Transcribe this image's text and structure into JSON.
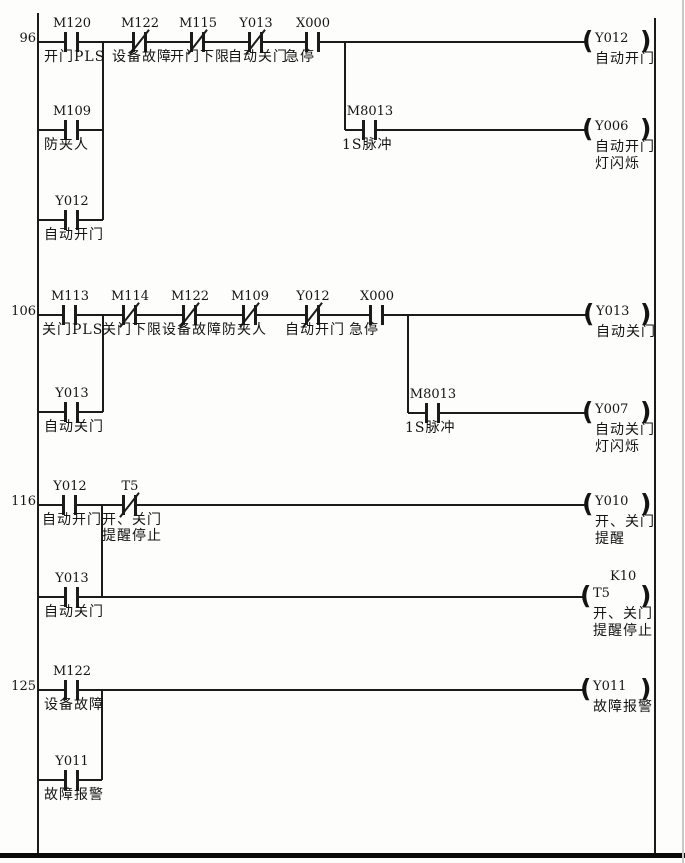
{
  "diagram": {
    "type": "plc-ladder",
    "bg_color": "#fdfdfc",
    "line_color": "#1b1b1b",
    "rails": {
      "left_x": 38,
      "right_x": 655,
      "top_y": 13,
      "right_top_y": 18,
      "bottom_y": 855
    },
    "frame": {
      "bottom_bar_y": 853,
      "bottom_bar_h": 5,
      "right_edge_x": 682
    },
    "rungs": [
      {
        "number": "96",
        "y": 42,
        "wires": [
          {
            "t": "h",
            "x1": 38,
            "x2": 585,
            "y": 42
          },
          {
            "t": "v",
            "x": 103,
            "y1": 42,
            "y2": 220
          },
          {
            "t": "h",
            "x1": 38,
            "x2": 103,
            "y": 130
          },
          {
            "t": "v",
            "x": 345,
            "y1": 42,
            "y2": 130
          },
          {
            "t": "h",
            "x1": 345,
            "x2": 585,
            "y": 130
          },
          {
            "t": "h",
            "x1": 38,
            "x2": 103,
            "y": 220
          }
        ],
        "contacts": [
          {
            "x": 72,
            "y": 42,
            "name": "M120",
            "label": [
              "开门PLS"
            ],
            "nc": false
          },
          {
            "x": 140,
            "y": 42,
            "name": "M122",
            "label": [
              "设备故障"
            ],
            "nc": true
          },
          {
            "x": 198,
            "y": 42,
            "name": "M115",
            "label": [
              "开门下限"
            ],
            "nc": true
          },
          {
            "x": 256,
            "y": 42,
            "name": "Y013",
            "label": [
              "自动关门"
            ],
            "nc": true
          },
          {
            "x": 313,
            "y": 42,
            "name": "X000",
            "label": [
              "急停"
            ],
            "nc": false
          },
          {
            "x": 72,
            "y": 130,
            "name": "M109",
            "label": [
              "防夹人"
            ],
            "nc": false
          },
          {
            "x": 370,
            "y": 130,
            "name": "M8013",
            "label": [
              "1S脉冲"
            ],
            "nc": false
          },
          {
            "x": 72,
            "y": 220,
            "name": "Y012",
            "label": [
              "自动开门"
            ],
            "nc": false
          }
        ],
        "coils": [
          {
            "x": 585,
            "y": 42,
            "name": "Y012",
            "label": [
              "自动开门"
            ]
          },
          {
            "x": 585,
            "y": 130,
            "name": "Y006",
            "label": [
              "自动开门",
              "灯闪烁"
            ]
          }
        ]
      },
      {
        "number": "106",
        "y": 315,
        "wires": [
          {
            "t": "h",
            "x1": 38,
            "x2": 586,
            "y": 315
          },
          {
            "t": "v",
            "x": 103,
            "y1": 315,
            "y2": 412
          },
          {
            "t": "h",
            "x1": 38,
            "x2": 103,
            "y": 412
          },
          {
            "t": "v",
            "x": 408,
            "y1": 315,
            "y2": 413
          },
          {
            "t": "h",
            "x1": 408,
            "x2": 585,
            "y": 413
          }
        ],
        "contacts": [
          {
            "x": 70,
            "y": 315,
            "name": "M113",
            "label": [
              "关门PLS"
            ],
            "nc": false
          },
          {
            "x": 130,
            "y": 315,
            "name": "M114",
            "label": [
              "关门下限"
            ],
            "nc": true
          },
          {
            "x": 190,
            "y": 315,
            "name": "M122",
            "label": [
              "设备故障"
            ],
            "nc": true
          },
          {
            "x": 250,
            "y": 315,
            "name": "M109",
            "label": [
              "防夹人"
            ],
            "nc": true
          },
          {
            "x": 313,
            "y": 315,
            "name": "Y012",
            "label": [
              "自动开门"
            ],
            "nc": true
          },
          {
            "x": 377,
            "y": 315,
            "name": "X000",
            "label": [
              "急停"
            ],
            "nc": false
          },
          {
            "x": 433,
            "y": 413,
            "name": "M8013",
            "label": [
              "1S脉冲"
            ],
            "nc": false
          },
          {
            "x": 72,
            "y": 412,
            "name": "Y013",
            "label": [
              "自动关门"
            ],
            "nc": false
          }
        ],
        "coils": [
          {
            "x": 586,
            "y": 315,
            "name": "Y013",
            "label": [
              "自动关门"
            ]
          },
          {
            "x": 585,
            "y": 413,
            "name": "Y007",
            "label": [
              "自动关门",
              "灯闪烁"
            ]
          }
        ]
      },
      {
        "number": "116",
        "y": 505,
        "wires": [
          {
            "t": "h",
            "x1": 38,
            "x2": 585,
            "y": 505
          },
          {
            "t": "v",
            "x": 102,
            "y1": 505,
            "y2": 597
          },
          {
            "t": "h",
            "x1": 38,
            "x2": 583,
            "y": 597
          }
        ],
        "contacts": [
          {
            "x": 70,
            "y": 505,
            "name": "Y012",
            "label": [
              "自动开门"
            ],
            "nc": false
          },
          {
            "x": 130,
            "y": 505,
            "name": "T5",
            "label": [
              "开、关门",
              "提醒停止"
            ],
            "nc": true
          },
          {
            "x": 72,
            "y": 597,
            "name": "Y013",
            "label": [
              "自动关门"
            ],
            "nc": false
          }
        ],
        "coils": [
          {
            "x": 585,
            "y": 505,
            "name": "Y010",
            "label": [
              "开、关门",
              "提醒"
            ]
          },
          {
            "x": 583,
            "y": 597,
            "name": "T5",
            "k": "K10",
            "label": [
              "开、关门",
              "提醒停止"
            ]
          }
        ]
      },
      {
        "number": "125",
        "y": 690,
        "wires": [
          {
            "t": "h",
            "x1": 38,
            "x2": 583,
            "y": 690
          },
          {
            "t": "v",
            "x": 102,
            "y1": 690,
            "y2": 780
          },
          {
            "t": "h",
            "x1": 38,
            "x2": 102,
            "y": 780
          }
        ],
        "contacts": [
          {
            "x": 72,
            "y": 690,
            "name": "M122",
            "label": [
              "设备故障"
            ],
            "nc": false
          },
          {
            "x": 72,
            "y": 780,
            "name": "Y011",
            "label": [
              "故障报警"
            ],
            "nc": false
          }
        ],
        "coils": [
          {
            "x": 583,
            "y": 690,
            "name": "Y011",
            "label": [
              "故障报警"
            ]
          }
        ]
      }
    ]
  }
}
